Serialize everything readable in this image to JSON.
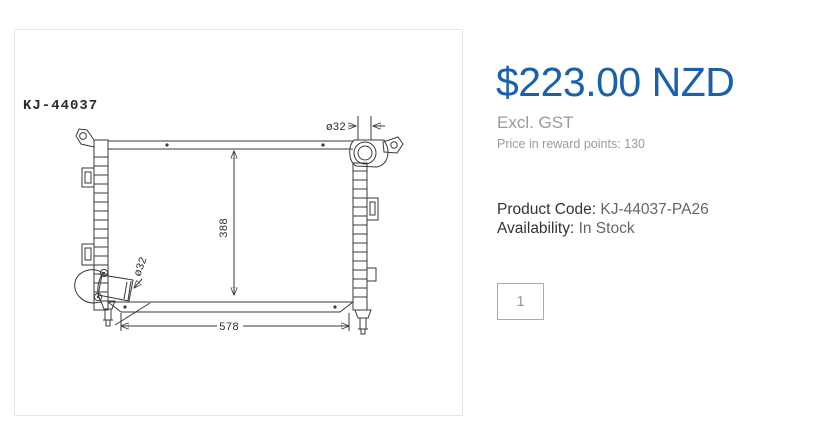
{
  "product_image": {
    "part_number": "KJ-44037",
    "dimensions": {
      "core_height": "388",
      "core_width": "578",
      "top_port_diameter": "ø32",
      "bottom_port_diameter": "ø32"
    }
  },
  "product": {
    "price": "$223.00 NZD",
    "tax_note": "Excl. GST",
    "reward_points_text": "Price in reward points: 130",
    "product_code_label": "Product Code:",
    "product_code_value": "KJ-44037-PA26",
    "availability_label": "Availability:",
    "availability_value": "In Stock"
  },
  "purchase": {
    "quantity": "1"
  },
  "colors": {
    "price_blue": "#1b61a9",
    "muted_gray": "#9b9b9b",
    "label_dark": "#333333",
    "value_gray": "#666666",
    "drawing_stroke": "#3a3a3a",
    "panel_border": "#e6e6e6",
    "input_border": "#ababab"
  }
}
